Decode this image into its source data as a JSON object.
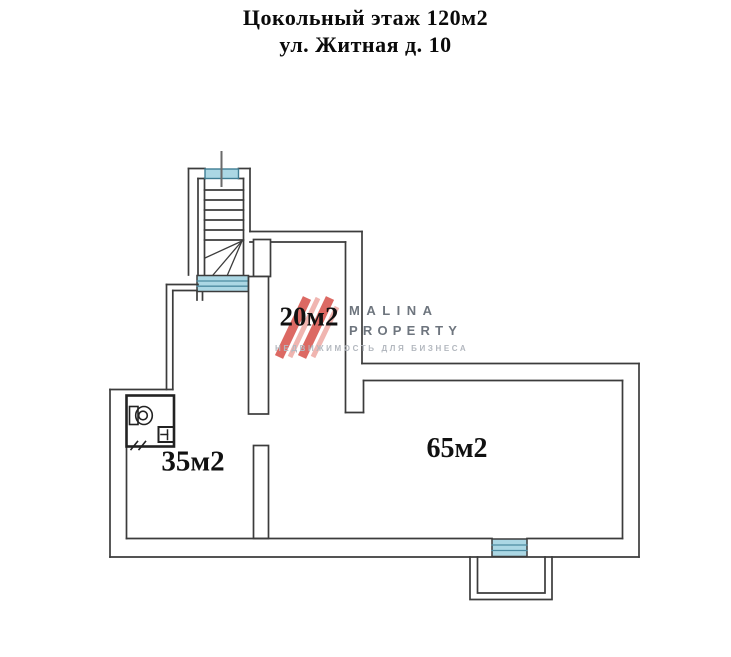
{
  "header": {
    "title_line1": "Цокольный этаж 120м2",
    "title_line2": "ул. Житная д. 10"
  },
  "rooms": [
    {
      "id": "corridor",
      "label": "20м2"
    },
    {
      "id": "left-room",
      "label": "35м2"
    },
    {
      "id": "main-room",
      "label": "65м2"
    }
  ],
  "logo": {
    "line1": "MALINA",
    "line2": "PROPERTY",
    "tagline": "НЕДВИЖИМОСТЬ ДЛЯ БИЗНЕСА",
    "mark_color": "#dc6963",
    "mark_color_light": "#f0b5b0"
  },
  "plan": {
    "line_color": "#3c3c3c",
    "window_fill": "#abd7e4",
    "window_border": "#3f7d93",
    "window_mullion": "#4c8ba1"
  }
}
